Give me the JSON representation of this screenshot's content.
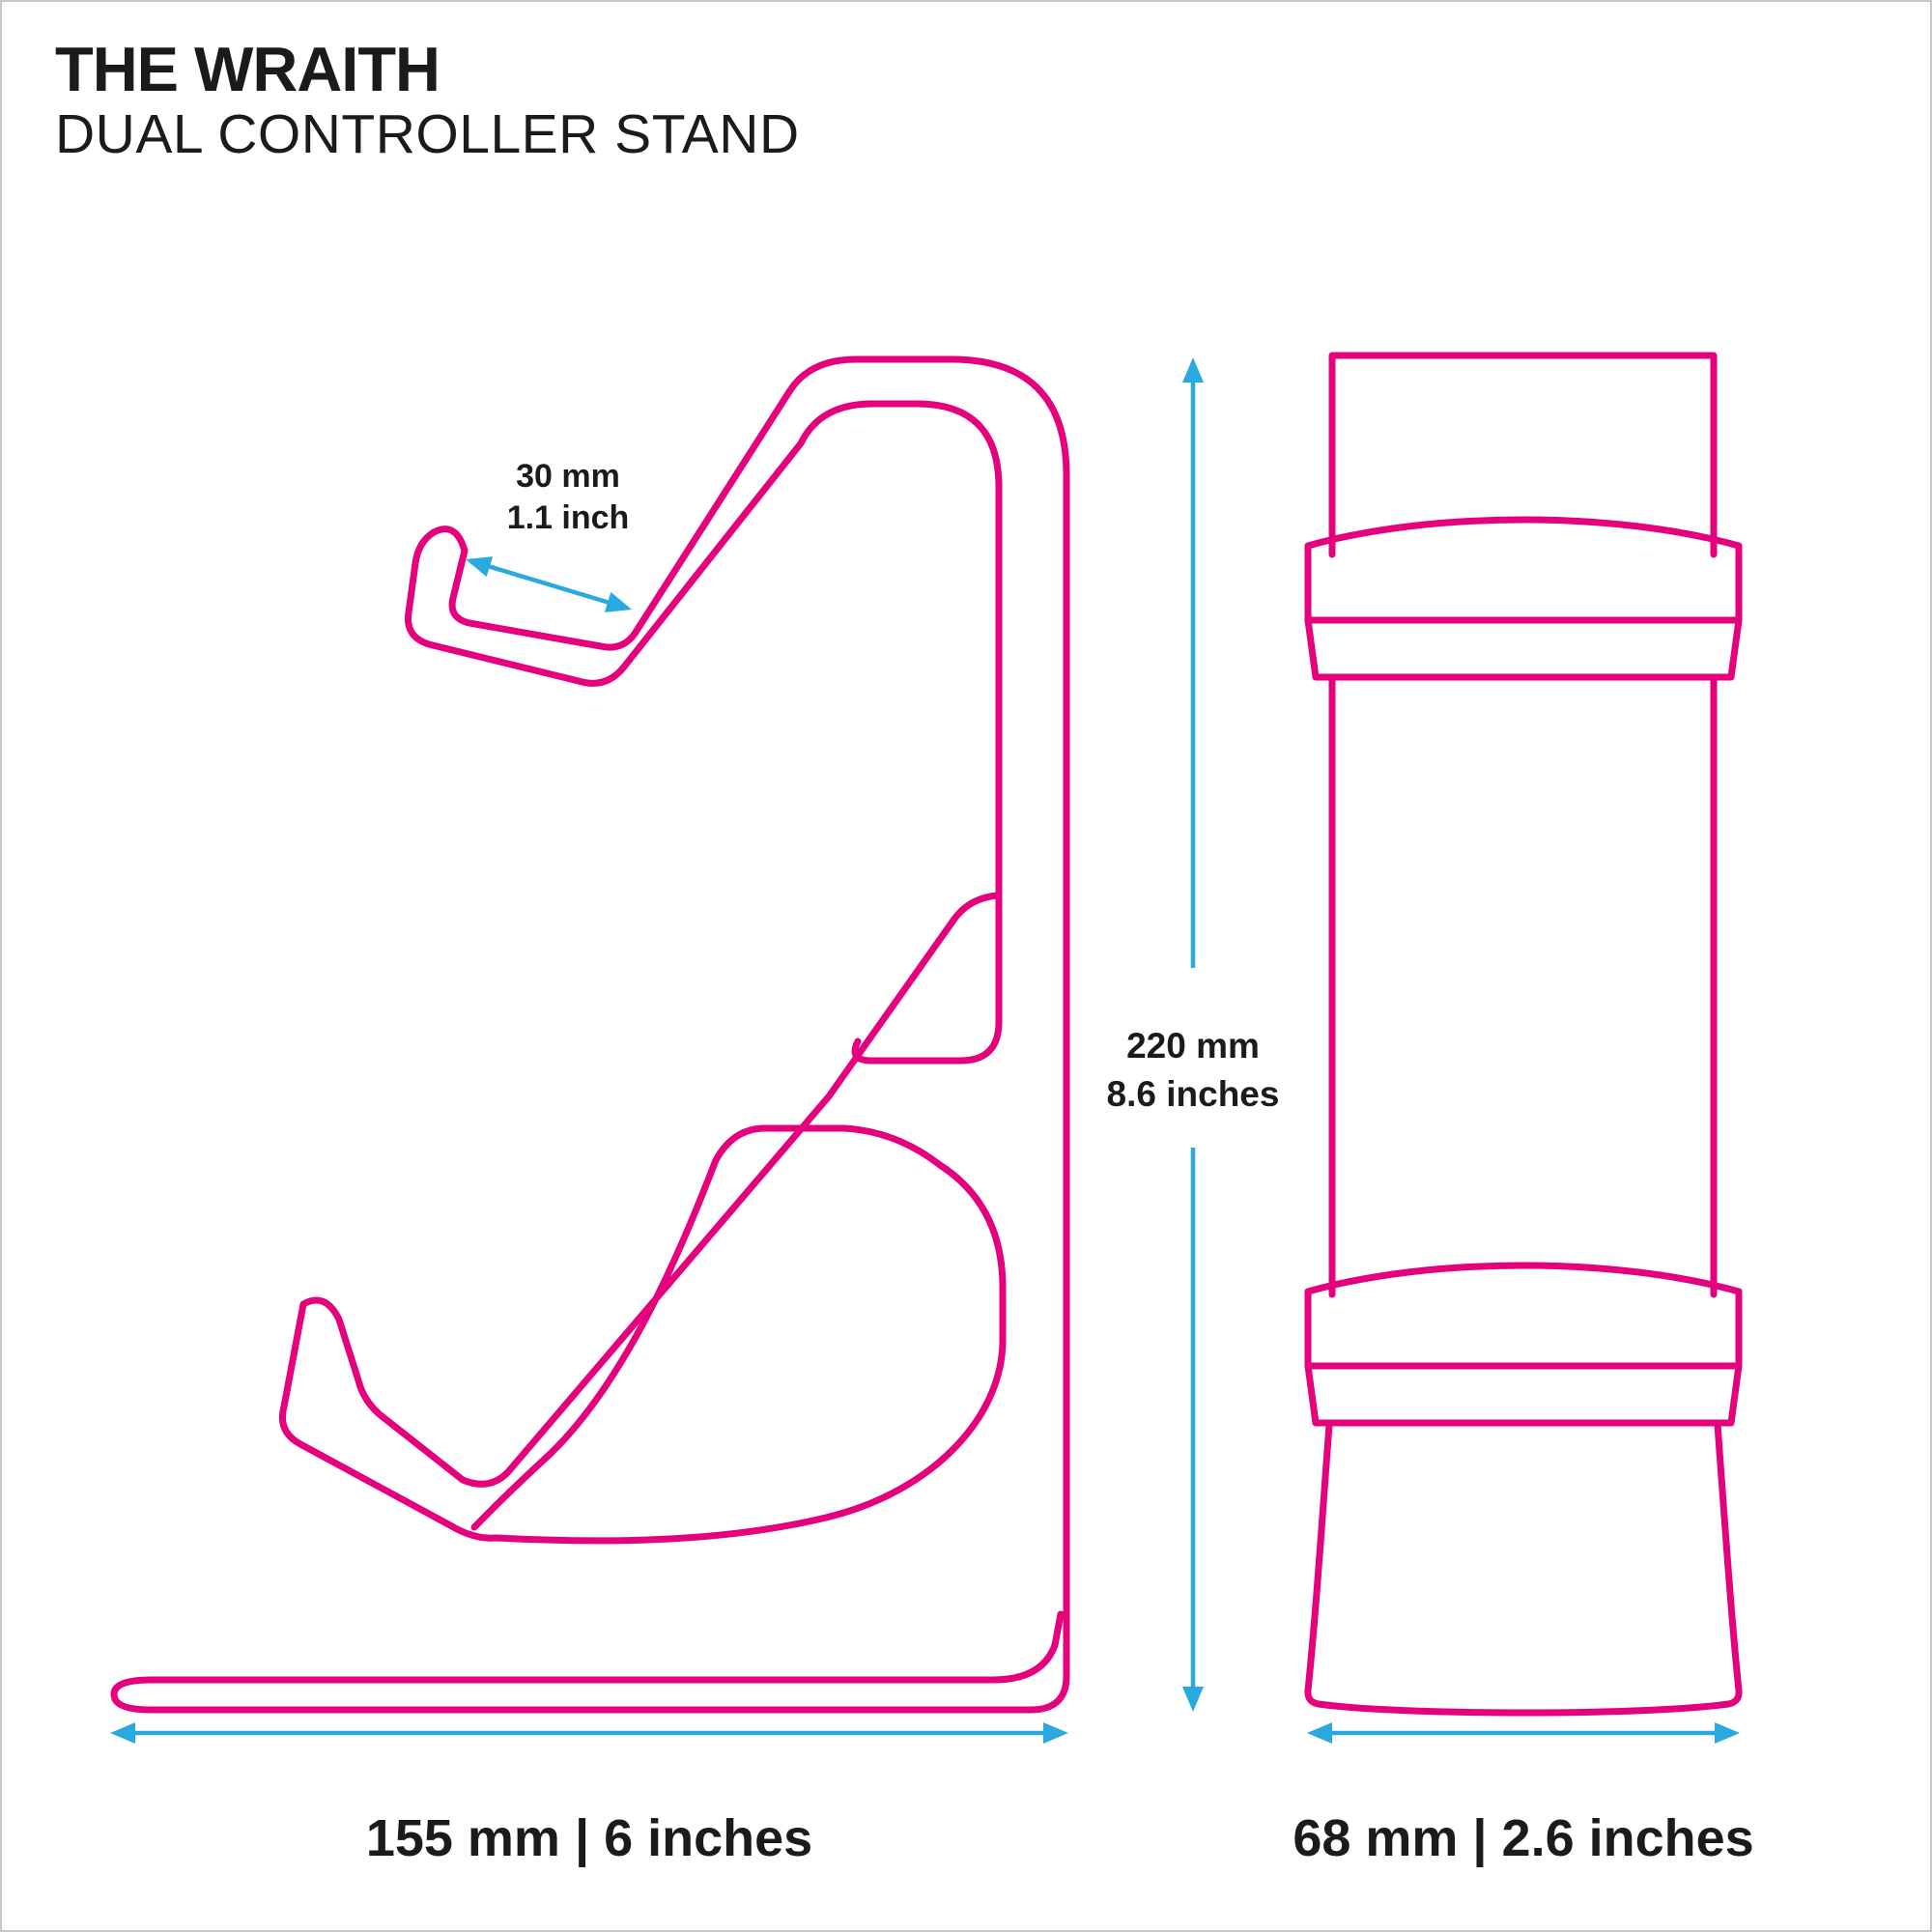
{
  "header": {
    "title": "THE WRAITH",
    "subtitle": "DUAL CONTROLLER STAND"
  },
  "colors": {
    "outline_pink": "#e5007e",
    "dimension_blue": "#29a9e0",
    "text_black": "#1b1b1b",
    "page_border_gray": "#c8c8c8",
    "background": "#ffffff"
  },
  "annotations": {
    "hook_depth": {
      "line1": "30 mm",
      "line2": "1.1 inch"
    },
    "overall_height": {
      "line1": "220 mm",
      "line2": "8.6 inches"
    },
    "base_depth": {
      "label": "155 mm | 6 inches"
    },
    "stand_width": {
      "label": "68 mm | 2.6 inches"
    }
  }
}
